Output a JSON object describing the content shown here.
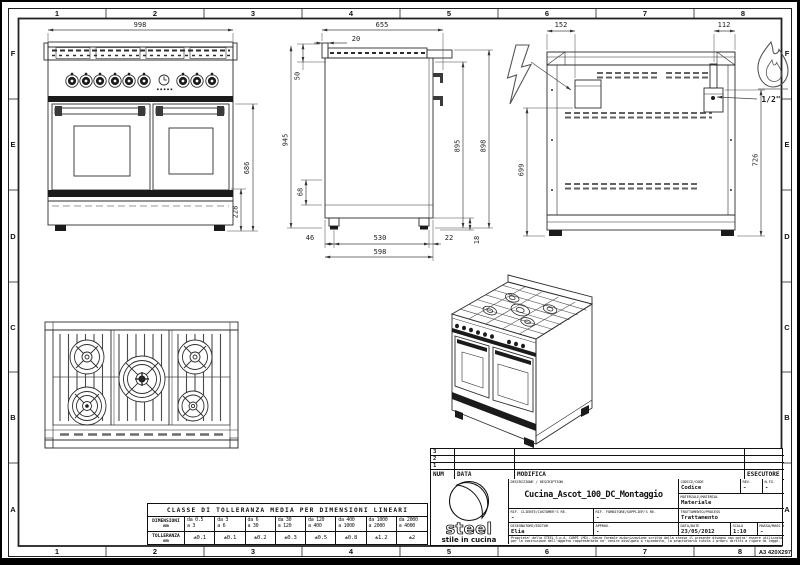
{
  "frame": {
    "top_numbers": [
      "1",
      "2",
      "3",
      "4",
      "5",
      "6",
      "7",
      "8"
    ],
    "bottom_numbers": [
      "1",
      "2",
      "3",
      "4",
      "5",
      "6",
      "7",
      "8"
    ],
    "left_letters": [
      "F",
      "E",
      "D",
      "C",
      "B",
      "A"
    ],
    "right_letters": [
      "F",
      "E",
      "D",
      "C",
      "B",
      "A"
    ],
    "sheet_format": "A3 420X297"
  },
  "drawing": {
    "dims": {
      "front_width": "998",
      "front_oven_height": "686",
      "front_drawer_height": "228",
      "side_depth_total": "655",
      "side_back_gap": "20",
      "side_splash_height": "50",
      "side_overall_height": "945",
      "side_lower_offset": "68",
      "side_front_height_inner": "895",
      "side_front_height_outer": "898",
      "side_foot_back": "46",
      "side_foot_span": "530",
      "side_foot_front": "22",
      "side_base_depth": "598",
      "side_foot_height": "18",
      "back_elec_offset": "152",
      "back_gas_offset": "112",
      "back_elec_height": "699",
      "back_gas_height": "726",
      "gas_connection": "1/2\""
    }
  },
  "tolerance_table": {
    "title": "CLASSE DI TOLLERANZA MEDIA PER DIMENSIONI LINEARI",
    "dim_label": "DIMENSIONI",
    "tol_label": "TOLLERANZA",
    "unit": "mm",
    "ranges": [
      {
        "da": "da 0.5",
        "a": "a 3"
      },
      {
        "da": "da 3",
        "a": "a 6"
      },
      {
        "da": "da 6",
        "a": "a 30"
      },
      {
        "da": "da 30",
        "a": "a 120"
      },
      {
        "da": "da 120",
        "a": "a 400"
      },
      {
        "da": "da 400",
        "a": "a 1000"
      },
      {
        "da": "da 1000",
        "a": "a 2000"
      },
      {
        "da": "da 2000",
        "a": "a 4000"
      }
    ],
    "tolerances": [
      "±0.1",
      "±0.1",
      "±0.2",
      "±0.3",
      "±0.5",
      "±0.8",
      "±1.2",
      "±2"
    ]
  },
  "revision_table": {
    "rows": [
      "3",
      "2",
      "1"
    ],
    "num_header": "NUM",
    "data_header": "DATA",
    "modifica_header": "MODIFICA",
    "esecutore_header": "ESECUTORE"
  },
  "title_block": {
    "descrizione_label": "DESCRIZIONE / DESCRIPTION",
    "descrizione": "Cucina_Ascot_100_DC_Montaggio",
    "codice_label": "CODICE/CODE",
    "codice": "Codice",
    "rev_label": "REV.",
    "rev": "-",
    "nfg_label": "N.FG.",
    "nfg": "-",
    "materiale_label": "MATERIALE/MATERIAL",
    "materiale": "Materiale",
    "rif_cliente_label": "RIF. CLIENTE/CUSTOMER'S RE.",
    "rif_cliente": "-",
    "rif_fornitore_label": "RIF. FORNITORE/SUPPLIER'S RE.",
    "rif_fornitore": "-",
    "trattamento_label": "TRATTAMENTO/PROCESS",
    "trattamento": "Trattamento",
    "disegnatore_label": "DISEGNATORE/EDITOR",
    "disegnatore": "Elia",
    "approv_label": "APPROV.",
    "approv": "-",
    "data_label": "DATA/DATE",
    "data": "23/05/2012",
    "scala_label": "SCALA",
    "scala": "1:10",
    "massa_label": "MASSA/MASS kg",
    "massa": "-",
    "disclaimer": "Proprieta' della STEEL S.p.A. CARPI (MO). Senza formale autorizzazione scritta della stessa il presente disegno non potra' essere utilizzato per la costruzione dell'oggetto rappresentato ne' venire divulgato o riprodotto, la proprietaria tutela i propri diritti a rigore di legge."
  },
  "logo": {
    "name": "steel",
    "tagline": "stile in cucina"
  }
}
